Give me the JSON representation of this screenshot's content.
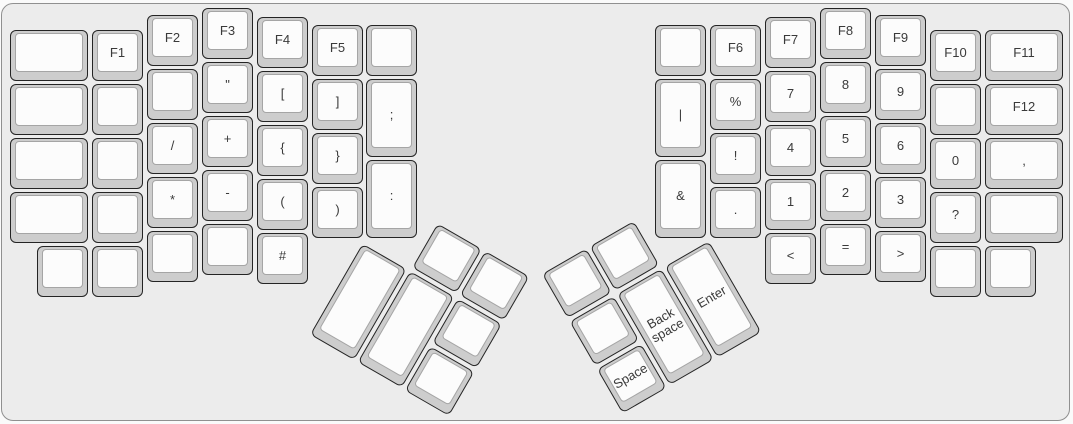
{
  "keyboard": {
    "description": "Split ergonomic keyboard layout, symbol and function layer",
    "colors": {
      "panel_bg": "#ececec",
      "panel_border": "#909090",
      "key_base": "#cdcdcd",
      "key_border": "#242424",
      "key_top": "#fcfcfc",
      "key_top_border": "#a5a5a5",
      "label": "#3a3a3a"
    },
    "keys": [
      {
        "name": "blank",
        "label": "",
        "x": 10,
        "y": 30,
        "w": 78
      },
      {
        "name": "blank",
        "label": "",
        "x": 10,
        "y": 84,
        "w": 78
      },
      {
        "name": "blank",
        "label": "",
        "x": 10,
        "y": 138,
        "w": 78
      },
      {
        "name": "blank",
        "label": "",
        "x": 10,
        "y": 192,
        "w": 78
      },
      {
        "name": "f1",
        "label": "F1",
        "x": 92,
        "y": 30
      },
      {
        "name": "blank",
        "label": "",
        "x": 92,
        "y": 84
      },
      {
        "name": "blank",
        "label": "",
        "x": 92,
        "y": 138
      },
      {
        "name": "blank",
        "label": "",
        "x": 92,
        "y": 192
      },
      {
        "name": "blank",
        "label": "",
        "x": 37,
        "y": 246
      },
      {
        "name": "blank",
        "label": "",
        "x": 92,
        "y": 246
      },
      {
        "name": "f2",
        "label": "F2",
        "x": 147,
        "y": 15
      },
      {
        "name": "blank",
        "label": "",
        "x": 147,
        "y": 69
      },
      {
        "name": "slash",
        "label": "/",
        "x": 147,
        "y": 123
      },
      {
        "name": "asterisk",
        "label": "*",
        "x": 147,
        "y": 177
      },
      {
        "name": "blank",
        "label": "",
        "x": 147,
        "y": 231
      },
      {
        "name": "f3",
        "label": "F3",
        "x": 202,
        "y": 8
      },
      {
        "name": "double-quote",
        "label": "\"",
        "x": 202,
        "y": 62
      },
      {
        "name": "plus",
        "label": "+",
        "x": 202,
        "y": 116
      },
      {
        "name": "minus",
        "label": "-",
        "x": 202,
        "y": 170
      },
      {
        "name": "blank",
        "label": "",
        "x": 202,
        "y": 224
      },
      {
        "name": "f4",
        "label": "F4",
        "x": 257,
        "y": 17
      },
      {
        "name": "left-bracket",
        "label": "[",
        "x": 257,
        "y": 71
      },
      {
        "name": "left-brace",
        "label": "{",
        "x": 257,
        "y": 125
      },
      {
        "name": "left-paren",
        "label": "(",
        "x": 257,
        "y": 179
      },
      {
        "name": "hash",
        "label": "#",
        "x": 257,
        "y": 233
      },
      {
        "name": "f5",
        "label": "F5",
        "x": 312,
        "y": 25
      },
      {
        "name": "right-bracket",
        "label": "]",
        "x": 312,
        "y": 79
      },
      {
        "name": "right-brace",
        "label": "}",
        "x": 312,
        "y": 133
      },
      {
        "name": "right-paren",
        "label": ")",
        "x": 312,
        "y": 187
      },
      {
        "name": "blank",
        "label": "",
        "x": 366,
        "y": 25
      },
      {
        "name": "semicolon",
        "label": ";",
        "x": 366,
        "y": 79,
        "h": 78
      },
      {
        "name": "colon",
        "label": ":",
        "x": 366,
        "y": 160,
        "h": 78
      },
      {
        "name": "blank",
        "label": "",
        "x": 655,
        "y": 25
      },
      {
        "name": "pipe",
        "label": "|",
        "x": 655,
        "y": 79,
        "h": 78
      },
      {
        "name": "ampersand",
        "label": "&",
        "x": 655,
        "y": 160,
        "h": 78
      },
      {
        "name": "f6",
        "label": "F6",
        "x": 710,
        "y": 25
      },
      {
        "name": "percent",
        "label": "%",
        "x": 710,
        "y": 79
      },
      {
        "name": "exclamation",
        "label": "!",
        "x": 710,
        "y": 133
      },
      {
        "name": "period",
        "label": ".",
        "x": 710,
        "y": 187
      },
      {
        "name": "f7",
        "label": "F7",
        "x": 765,
        "y": 17
      },
      {
        "name": "seven",
        "label": "7",
        "x": 765,
        "y": 71
      },
      {
        "name": "four",
        "label": "4",
        "x": 765,
        "y": 125
      },
      {
        "name": "one",
        "label": "1",
        "x": 765,
        "y": 179
      },
      {
        "name": "less-than",
        "label": "<",
        "x": 765,
        "y": 233
      },
      {
        "name": "f8",
        "label": "F8",
        "x": 820,
        "y": 8
      },
      {
        "name": "eight",
        "label": "8",
        "x": 820,
        "y": 62
      },
      {
        "name": "five",
        "label": "5",
        "x": 820,
        "y": 116
      },
      {
        "name": "two",
        "label": "2",
        "x": 820,
        "y": 170
      },
      {
        "name": "equals",
        "label": "=",
        "x": 820,
        "y": 224
      },
      {
        "name": "f9",
        "label": "F9",
        "x": 875,
        "y": 15
      },
      {
        "name": "nine",
        "label": "9",
        "x": 875,
        "y": 69
      },
      {
        "name": "six",
        "label": "6",
        "x": 875,
        "y": 123
      },
      {
        "name": "three",
        "label": "3",
        "x": 875,
        "y": 177
      },
      {
        "name": "greater-than",
        "label": ">",
        "x": 875,
        "y": 231
      },
      {
        "name": "f10",
        "label": "F10",
        "x": 930,
        "y": 30
      },
      {
        "name": "blank",
        "label": "",
        "x": 930,
        "y": 84
      },
      {
        "name": "zero",
        "label": "0",
        "x": 930,
        "y": 138
      },
      {
        "name": "question",
        "label": "?",
        "x": 930,
        "y": 192
      },
      {
        "name": "blank",
        "label": "",
        "x": 930,
        "y": 246
      },
      {
        "name": "blank",
        "label": "",
        "x": 985,
        "y": 246
      },
      {
        "name": "f11",
        "label": "F11",
        "x": 985,
        "y": 30,
        "w": 78
      },
      {
        "name": "f12",
        "label": "F12",
        "x": 985,
        "y": 84,
        "w": 78
      },
      {
        "name": "comma",
        "label": ",",
        "x": 985,
        "y": 138,
        "w": 78
      },
      {
        "name": "blank",
        "label": "",
        "x": 985,
        "y": 192,
        "w": 78
      }
    ],
    "clusters": [
      {
        "name": "left-thumb-cluster",
        "x": 390,
        "y": 196,
        "rotation": 30,
        "keys": [
          {
            "name": "blank",
            "label": "",
            "x": 55,
            "y": 0
          },
          {
            "name": "blank",
            "label": "",
            "x": 110,
            "y": 0
          },
          {
            "name": "blank",
            "label": "",
            "x": 0,
            "y": 55,
            "h": 105
          },
          {
            "name": "blank",
            "label": "",
            "x": 55,
            "y": 55,
            "h": 105
          },
          {
            "name": "blank",
            "label": "",
            "x": 110,
            "y": 55
          },
          {
            "name": "blank",
            "label": "",
            "x": 110,
            "y": 110
          }
        ]
      },
      {
        "name": "right-thumb-cluster",
        "x": 542,
        "y": 274,
        "rotation": -30,
        "keys": [
          {
            "name": "blank",
            "label": "",
            "x": 0,
            "y": 0
          },
          {
            "name": "blank",
            "label": "",
            "x": 55,
            "y": 0
          },
          {
            "name": "blank",
            "label": "",
            "x": 0,
            "y": 55
          },
          {
            "name": "space",
            "label": "Space",
            "x": 0,
            "y": 110
          },
          {
            "name": "backspace",
            "label": "Back space",
            "x": 55,
            "y": 55,
            "h": 105
          },
          {
            "name": "enter",
            "label": "Enter",
            "x": 110,
            "y": 55,
            "h": 105
          }
        ]
      }
    ]
  }
}
